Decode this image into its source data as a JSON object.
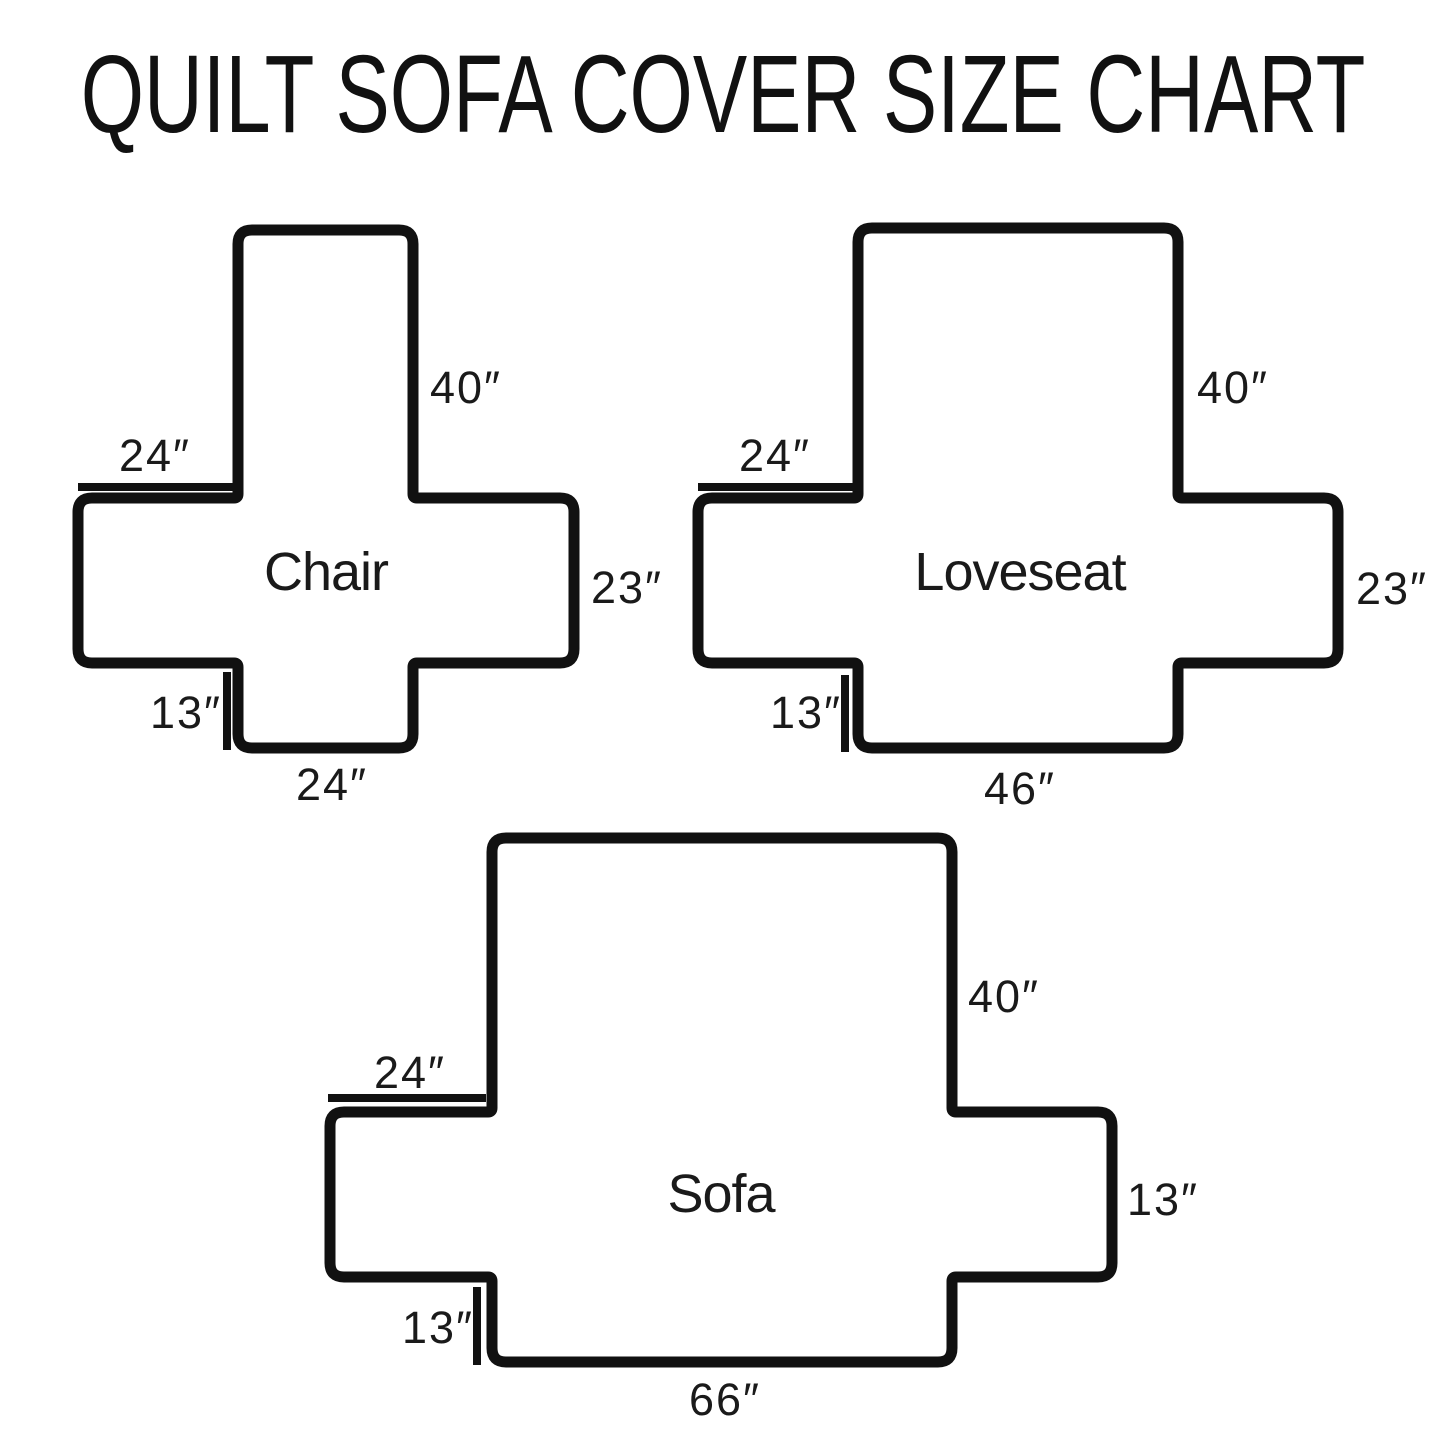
{
  "title": "QUILT SOFA COVER SIZE CHART",
  "shapes": [
    {
      "name": "Chair",
      "dimensions": {
        "back_height": "40″",
        "arm_top_width": "24″",
        "side_height": "23″",
        "skirt_height": "13″",
        "seat_width": "24″"
      }
    },
    {
      "name": "Loveseat",
      "dimensions": {
        "back_height": "40″",
        "arm_top_width": "24″",
        "side_height": "23″",
        "skirt_height": "13″",
        "seat_width": "46″"
      }
    },
    {
      "name": "Sofa",
      "dimensions": {
        "back_height": "40″",
        "arm_top_width": "24″",
        "side_height": "13″",
        "skirt_height": "13″",
        "seat_width": "66″"
      }
    }
  ],
  "colors": {
    "ink": "#111111",
    "background": "#ffffff"
  }
}
